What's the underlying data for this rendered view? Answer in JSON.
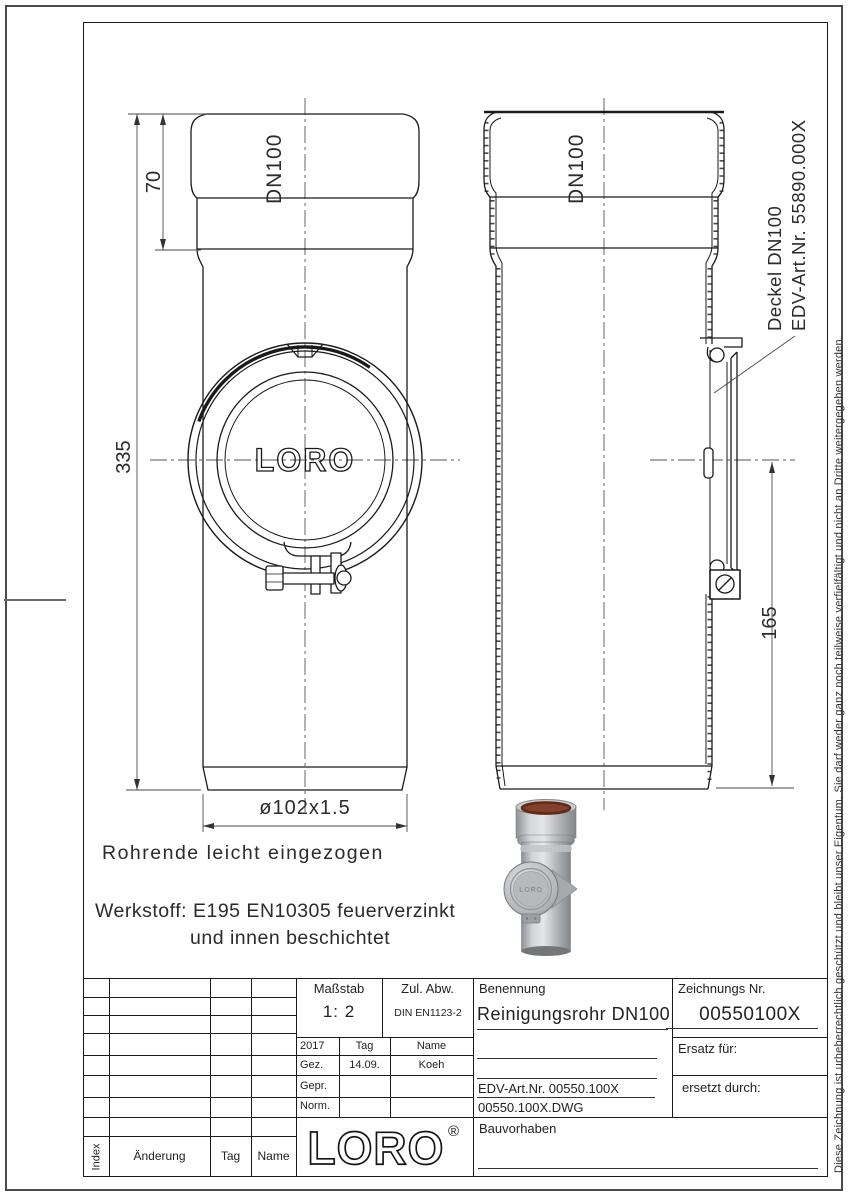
{
  "drawing": {
    "dims": {
      "socket_depth": "70",
      "total_length": "335",
      "opening_height": "165",
      "diameter": "ø102x1.5"
    },
    "labels": {
      "dn_left": "DN100",
      "dn_right": "DN100",
      "deckel": "Deckel DN100",
      "deckel_edv": "EDV-Art.Nr. 55890.000X",
      "cover_logo": "LORO"
    },
    "notes": {
      "rohrende": "Rohrende leicht eingezogen",
      "werkstoff1": "Werkstoff: E195 EN10305 feuerverzinkt",
      "werkstoff2": "und innen beschichtet"
    }
  },
  "photo": {
    "logo": "LORO"
  },
  "margin": {
    "copyright": "Diese Zeichnung ist urheberrechtlich geschützt und bleibt unser Eigentum. Sie darf weder ganz noch teilweise verfielfältigt und nicht an Dritte weitergegeben werden."
  },
  "title_block": {
    "massstab_label": "Maßstab",
    "massstab_value": "1: 2",
    "zul_abw_label": "Zul. Abw.",
    "zul_abw_value": "DIN EN1123-2",
    "year": "2017",
    "tag_header": "Tag",
    "name_header": "Name",
    "gez_label": "Gez.",
    "gez_tag": "14.09.",
    "gez_name": "Koeh",
    "gepr_label": "Gepr.",
    "norm_label": "Norm.",
    "benennung_label": "Benennung",
    "benennung_value": "Reinigungsrohr DN100",
    "edv_art": "EDV-Art.Nr. 00550.100X",
    "dwg_file": "00550.100X.DWG",
    "zeichnungs_label": "Zeichnungs Nr.",
    "zeichnungs_value": "00550100X",
    "ersatz_label": "Ersatz für:",
    "ersetzt_label": "ersetzt durch:",
    "bauvorhaben_label": "Bauvorhaben",
    "logo": "LORO",
    "registered": "®",
    "rev_index": "Index",
    "rev_aenderung": "Änderung",
    "rev_tag": "Tag",
    "rev_name": "Name"
  }
}
